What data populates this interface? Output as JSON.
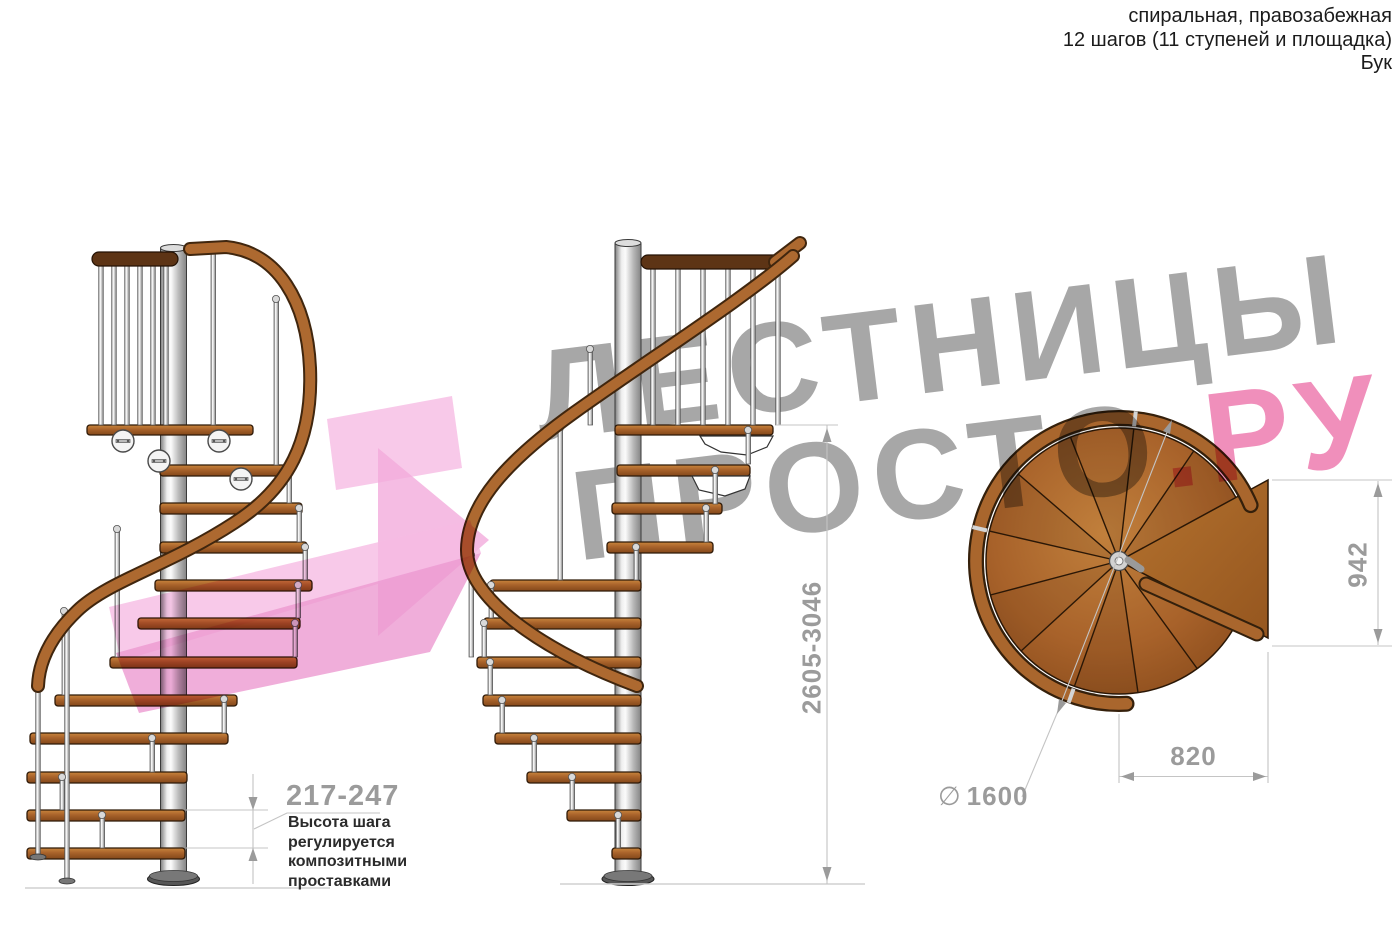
{
  "header": {
    "line1": "спиральная, правозабежная",
    "line2": "12 шагов (11 ступеней и площадка)",
    "line3": "Бук"
  },
  "watermark": {
    "line1": "ЛЕСТНИЦЫ",
    "line2_gray": "ПРОСТО",
    "line2_pink": ".РУ",
    "gray_color": "#a7a7a7",
    "pink_color": "#f08fbb"
  },
  "dimensions": {
    "step_height": {
      "value": "217-247",
      "note_lines": [
        "Высота шага",
        "регулируется",
        "композитными",
        "проставками"
      ]
    },
    "total_height": "2605-3046",
    "landing_depth": "942",
    "step_width": "820",
    "diameter": {
      "symbol": "∅",
      "value": "1600"
    }
  },
  "palette": {
    "wood_light": "#c9853d",
    "wood": "#a8622a",
    "wood_dark": "#82481a",
    "wood_outline": "#2f1a08",
    "handrail": "#ad6930",
    "balustrade_rail_dark": "#5d3415",
    "metal_light": "#fbfbfb",
    "metal_dark": "#848484",
    "dim_line": "#c4c4c4",
    "dim_text": "#9b9b9b",
    "note_text": "#2b2b2b",
    "header_text": "#1b1b1b",
    "arrow_pink": "#f3abdc"
  }
}
